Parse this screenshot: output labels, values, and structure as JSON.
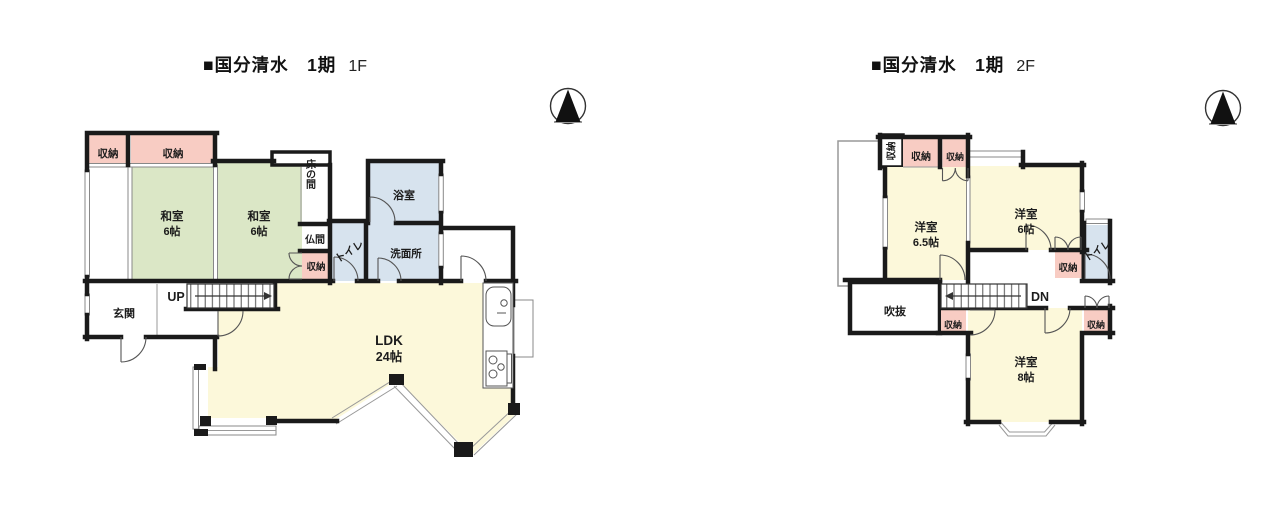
{
  "floors": [
    {
      "title_main": "■国分清水　1期",
      "floor_label": "1F",
      "rooms": {
        "closet_a": "収納",
        "closet_b": "収納",
        "washitsu1": {
          "name": "和室",
          "size": "6帖"
        },
        "washitsu2": {
          "name": "和室",
          "size": "6帖"
        },
        "tokonoma": "床の間",
        "butsuma": "仏間",
        "closet_c": "収納",
        "bath": "浴室",
        "toilet": "トイレ",
        "washroom": "洗面所",
        "entrance": "玄関",
        "stairs": "UP",
        "ldk": {
          "name": "LDK",
          "size": "24帖"
        }
      }
    },
    {
      "title_main": "■国分清水　1期",
      "floor_label": "2F",
      "rooms": {
        "closet_v": "収納",
        "closet_a": "収納",
        "closet_b": "収納",
        "bedroom1": {
          "name": "洋室",
          "size": "6.5帖"
        },
        "bedroom2": {
          "name": "洋室",
          "size": "6帖"
        },
        "toilet": "トイレ",
        "closet_c": "収納",
        "void": "吹抜",
        "stairs": "DN",
        "closet_d": "収納",
        "closet_e": "収納",
        "bedroom3": {
          "name": "洋室",
          "size": "8帖"
        }
      }
    }
  ],
  "icons": {
    "compass_1f": "north-compass-icon",
    "compass_2f": "north-compass-icon"
  },
  "colors": {
    "wall": "#1a1a1a",
    "tatami_green": "#dbe7c6",
    "flooring_yellow": "#fcf8da",
    "wet_area_blue": "#d7e3ee",
    "closet_pink": "#f8ccc3",
    "balcony_border": "#999999"
  }
}
